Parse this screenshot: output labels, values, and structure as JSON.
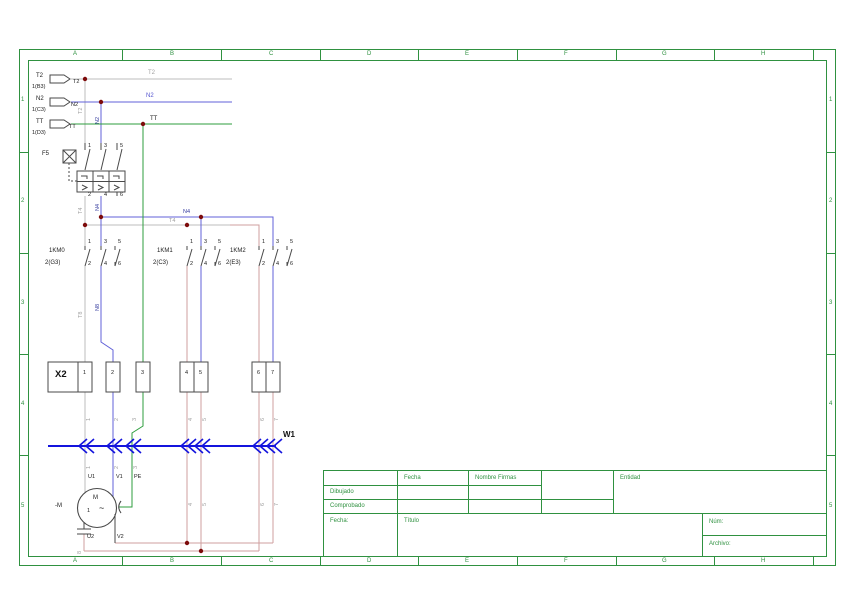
{
  "type": "electrical-schematic",
  "frame": {
    "columns": [
      "A",
      "B",
      "C",
      "D",
      "E",
      "F",
      "G",
      "H"
    ],
    "rows": [
      "1",
      "2",
      "3",
      "4",
      "5"
    ]
  },
  "title_block": {
    "fecha_header": "Fecha",
    "nombre_firmas": "Nombre Firmas",
    "dibujado": "Dibujado",
    "comprobado": "Comprobado",
    "fecha_label": "Fecha:",
    "titulo_label": "Título",
    "entidad_label": "Entidad",
    "num_label": "Núm:",
    "archivo_label": "Archivo:"
  },
  "schematic": {
    "sources": [
      {
        "tag": "T2",
        "ref": "1(B3)"
      },
      {
        "tag": "N2",
        "ref": "1(C3)"
      },
      {
        "tag": "TT",
        "ref": "1(D3)"
      }
    ],
    "breaker": {
      "tag": "F5",
      "pole_numbers": [
        "1",
        "3",
        "5",
        "2",
        "4",
        "6"
      ]
    },
    "contactors": [
      {
        "tag": "1KM0",
        "ref": "2(G3)"
      },
      {
        "tag": "1KM1",
        "ref": "2(C3)"
      },
      {
        "tag": "1KM2",
        "ref": "2(E3)"
      }
    ],
    "nets": [
      "T2",
      "N2",
      "TT",
      "N4",
      "T4",
      "N8",
      "T8"
    ],
    "terminal_strip": {
      "tag": "X2",
      "terminals": [
        "1",
        "2",
        "3",
        "4",
        "5",
        "6",
        "7"
      ]
    },
    "cable": {
      "tag": "W1"
    },
    "motor": {
      "tag": "-M",
      "type": "M 1~",
      "terminals": [
        "U1",
        "V1",
        "PE",
        "U2",
        "V2"
      ]
    },
    "wire_numbers": [
      "1",
      "2",
      "3",
      "4",
      "5",
      "6",
      "7",
      "8"
    ]
  },
  "labels": [
    {
      "t": "T2",
      "x": 36,
      "y": 73,
      "c": "k",
      "n": "source-tag-t2"
    },
    {
      "t": "1(B3)",
      "x": 32,
      "y": 85,
      "c": "k5",
      "n": "source-ref-t2"
    },
    {
      "t": "N2",
      "x": 36,
      "y": 96,
      "c": "k",
      "n": "source-tag-n2"
    },
    {
      "t": "1(C3)",
      "x": 32,
      "y": 108,
      "c": "k5",
      "n": "source-ref-n2"
    },
    {
      "t": "TT",
      "x": 36,
      "y": 119,
      "c": "k",
      "n": "source-tag-tt"
    },
    {
      "t": "1(D3)",
      "x": 32,
      "y": 131,
      "c": "k5",
      "n": "source-ref-tt"
    },
    {
      "t": "T2",
      "x": 73,
      "y": 80,
      "c": "k5",
      "n": "wire-label"
    },
    {
      "t": "N2",
      "x": 71,
      "y": 103,
      "c": "k5",
      "n": "wire-label"
    },
    {
      "t": "TT",
      "x": 69,
      "y": 125,
      "c": "k5",
      "n": "wire-label"
    },
    {
      "t": "T2",
      "x": 148,
      "y": 70,
      "c": "g",
      "n": "net-label-t2"
    },
    {
      "t": "N2",
      "x": 146,
      "y": 93,
      "c": "b",
      "n": "net-label-n2"
    },
    {
      "t": "TT",
      "x": 150,
      "y": 116,
      "c": "k",
      "n": "net-label-tt"
    },
    {
      "t": "T2",
      "x": 79,
      "y": 114,
      "c": "g5 rot",
      "n": "net-label-vertical"
    },
    {
      "t": "N2",
      "x": 96,
      "y": 124,
      "c": "db rot",
      "n": "net-label-vertical"
    },
    {
      "t": "F5",
      "x": 42,
      "y": 151,
      "c": "k",
      "n": "breaker-tag"
    },
    {
      "t": "1",
      "x": 88,
      "y": 144,
      "c": "k5",
      "n": "pole-number"
    },
    {
      "t": "3",
      "x": 104,
      "y": 144,
      "c": "k5",
      "n": "pole-number"
    },
    {
      "t": "5",
      "x": 120,
      "y": 144,
      "c": "k5",
      "n": "pole-number"
    },
    {
      "t": "2",
      "x": 88,
      "y": 193,
      "c": "k5",
      "n": "pole-number"
    },
    {
      "t": "4",
      "x": 104,
      "y": 193,
      "c": "k5",
      "n": "pole-number"
    },
    {
      "t": "6",
      "x": 120,
      "y": 193,
      "c": "k5",
      "n": "pole-number"
    },
    {
      "t": "T4",
      "x": 79,
      "y": 214,
      "c": "g5 rot",
      "n": "net-label-vertical"
    },
    {
      "t": "N4",
      "x": 96,
      "y": 211,
      "c": "db rot",
      "n": "net-label-vertical"
    },
    {
      "t": "N4",
      "x": 183,
      "y": 210,
      "c": "db",
      "n": "net-label-n4"
    },
    {
      "t": "T4",
      "x": 169,
      "y": 219,
      "c": "g5",
      "n": "net-label-t4"
    },
    {
      "t": "1KM0",
      "x": 49,
      "y": 248,
      "c": "k",
      "n": "contactor-tag-1km0"
    },
    {
      "t": "2(G3)",
      "x": 45,
      "y": 260,
      "c": "k",
      "n": "contactor-ref-1km0"
    },
    {
      "t": "1",
      "x": 88,
      "y": 240,
      "c": "k5",
      "n": "pole-number"
    },
    {
      "t": "3",
      "x": 104,
      "y": 240,
      "c": "k5",
      "n": "pole-number"
    },
    {
      "t": "5",
      "x": 118,
      "y": 240,
      "c": "k5",
      "n": "pole-number"
    },
    {
      "t": "2",
      "x": 88,
      "y": 262,
      "c": "k5",
      "n": "pole-number"
    },
    {
      "t": "4",
      "x": 104,
      "y": 262,
      "c": "k5",
      "n": "pole-number"
    },
    {
      "t": "6",
      "x": 118,
      "y": 262,
      "c": "k5",
      "n": "pole-number"
    },
    {
      "t": "1KM1",
      "x": 157,
      "y": 248,
      "c": "k",
      "n": "contactor-tag-1km1"
    },
    {
      "t": "2(C3)",
      "x": 153,
      "y": 260,
      "c": "k",
      "n": "contactor-ref-1km1"
    },
    {
      "t": "1",
      "x": 190,
      "y": 240,
      "c": "k5",
      "n": "pole-number"
    },
    {
      "t": "3",
      "x": 204,
      "y": 240,
      "c": "k5",
      "n": "pole-number"
    },
    {
      "t": "5",
      "x": 218,
      "y": 240,
      "c": "k5",
      "n": "pole-number"
    },
    {
      "t": "2",
      "x": 190,
      "y": 262,
      "c": "k5",
      "n": "pole-number"
    },
    {
      "t": "4",
      "x": 204,
      "y": 262,
      "c": "k5",
      "n": "pole-number"
    },
    {
      "t": "6",
      "x": 218,
      "y": 262,
      "c": "k5",
      "n": "pole-number"
    },
    {
      "t": "1KM2",
      "x": 230,
      "y": 248,
      "c": "k",
      "n": "contactor-tag-1km2"
    },
    {
      "t": "2(E3)",
      "x": 226,
      "y": 260,
      "c": "k",
      "n": "contactor-ref-1km2"
    },
    {
      "t": "1",
      "x": 262,
      "y": 240,
      "c": "k5",
      "n": "pole-number"
    },
    {
      "t": "3",
      "x": 276,
      "y": 240,
      "c": "k5",
      "n": "pole-number"
    },
    {
      "t": "5",
      "x": 290,
      "y": 240,
      "c": "k5",
      "n": "pole-number"
    },
    {
      "t": "2",
      "x": 262,
      "y": 262,
      "c": "k5",
      "n": "pole-number"
    },
    {
      "t": "4",
      "x": 276,
      "y": 262,
      "c": "k5",
      "n": "pole-number"
    },
    {
      "t": "6",
      "x": 290,
      "y": 262,
      "c": "k5",
      "n": "pole-number"
    },
    {
      "t": "T8",
      "x": 79,
      "y": 318,
      "c": "g5 rot",
      "n": "net-label-vertical"
    },
    {
      "t": "N8",
      "x": 96,
      "y": 311,
      "c": "db rot",
      "n": "net-label-vertical"
    },
    {
      "t": "X2",
      "x": 55,
      "y": 370,
      "c": "kb",
      "n": "terminal-strip-tag"
    },
    {
      "t": "1",
      "x": 83,
      "y": 371,
      "c": "k5",
      "n": "terminal-number"
    },
    {
      "t": "2",
      "x": 111,
      "y": 371,
      "c": "k5",
      "n": "terminal-number"
    },
    {
      "t": "3",
      "x": 141,
      "y": 371,
      "c": "k5",
      "n": "terminal-number"
    },
    {
      "t": "4",
      "x": 185,
      "y": 371,
      "c": "k5",
      "n": "terminal-number"
    },
    {
      "t": "5",
      "x": 199,
      "y": 371,
      "c": "k5",
      "n": "terminal-number"
    },
    {
      "t": "6",
      "x": 257,
      "y": 371,
      "c": "k5",
      "n": "terminal-number"
    },
    {
      "t": "7",
      "x": 271,
      "y": 371,
      "c": "k5",
      "n": "terminal-number"
    },
    {
      "t": "1",
      "x": 87,
      "y": 421,
      "c": "g5 rot",
      "n": "wire-number"
    },
    {
      "t": "2",
      "x": 115,
      "y": 421,
      "c": "g5 rot",
      "n": "wire-number"
    },
    {
      "t": "3",
      "x": 133,
      "y": 421,
      "c": "g5 rot",
      "n": "wire-number"
    },
    {
      "t": "4",
      "x": 189,
      "y": 421,
      "c": "g5 rot",
      "n": "wire-number"
    },
    {
      "t": "5",
      "x": 203,
      "y": 421,
      "c": "g5 rot",
      "n": "wire-number"
    },
    {
      "t": "6",
      "x": 261,
      "y": 421,
      "c": "g5 rot",
      "n": "wire-number"
    },
    {
      "t": "7",
      "x": 275,
      "y": 421,
      "c": "g5 rot",
      "n": "wire-number"
    },
    {
      "t": "1",
      "x": 87,
      "y": 469,
      "c": "g5 rot",
      "n": "wire-number"
    },
    {
      "t": "2",
      "x": 115,
      "y": 469,
      "c": "g5 rot",
      "n": "wire-number"
    },
    {
      "t": "3",
      "x": 134,
      "y": 469,
      "c": "g5 rot",
      "n": "wire-number"
    },
    {
      "t": "4",
      "x": 189,
      "y": 506,
      "c": "g5 rot",
      "n": "wire-number"
    },
    {
      "t": "5",
      "x": 203,
      "y": 506,
      "c": "g5 rot",
      "n": "wire-number"
    },
    {
      "t": "6",
      "x": 261,
      "y": 506,
      "c": "g5 rot",
      "n": "wire-number"
    },
    {
      "t": "7",
      "x": 275,
      "y": 506,
      "c": "g5 rot",
      "n": "wire-number"
    },
    {
      "t": "8",
      "x": 78,
      "y": 554,
      "c": "g5 rot",
      "n": "wire-number"
    },
    {
      "t": "W1",
      "x": 283,
      "y": 431,
      "c": "kb8",
      "n": "cable-tag"
    },
    {
      "t": "-M",
      "x": 55,
      "y": 503,
      "c": "k",
      "n": "motor-tag"
    },
    {
      "t": "U1",
      "x": 88,
      "y": 475,
      "c": "k5",
      "n": "motor-terminal-u1"
    },
    {
      "t": "V1",
      "x": 116,
      "y": 475,
      "c": "k5",
      "n": "motor-terminal-v1"
    },
    {
      "t": "PE",
      "x": 134,
      "y": 475,
      "c": "k5",
      "n": "motor-terminal-pe"
    },
    {
      "t": "M",
      "x": 93,
      "y": 495,
      "c": "k",
      "n": "motor-letter"
    },
    {
      "t": "1",
      "x": 87,
      "y": 509,
      "c": "k5",
      "n": "motor-phase-number"
    },
    {
      "t": "~",
      "x": 99,
      "y": 504,
      "c": "kt",
      "n": "motor-ac-symbol"
    },
    {
      "t": "U2",
      "x": 87,
      "y": 535,
      "c": "k5",
      "n": "motor-terminal-u2"
    },
    {
      "t": "V2",
      "x": 117,
      "y": 535,
      "c": "k5",
      "n": "motor-terminal-v2"
    }
  ]
}
